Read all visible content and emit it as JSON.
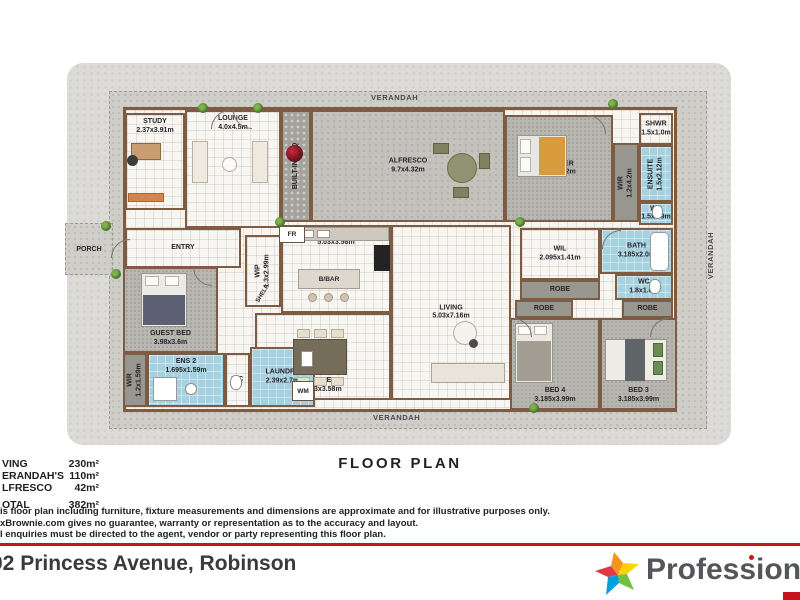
{
  "floor_plan_title": "FLOOR PLAN",
  "plan": {
    "verandah_top": "VERANDAH",
    "verandah_bottom": "VERANDAH",
    "verandah_right": "VERANDAH",
    "porch": "PORCH",
    "small_labels": {
      "fr": "FR",
      "wm": "WM",
      "shelf": "SHELF",
      "bbar": "B/BAR"
    },
    "rooms": [
      {
        "id": "study",
        "label": "STUDY",
        "dims": "2.37x3.91m",
        "type": "tile",
        "x": 60,
        "y": 58,
        "w": 60,
        "h": 97,
        "lp": "top"
      },
      {
        "id": "lounge",
        "label": "LOUNGE",
        "dims": "4.0x4.5m",
        "type": "tile",
        "x": 120,
        "y": 55,
        "w": 96,
        "h": 118,
        "lp": "top"
      },
      {
        "id": "built-in-bbq",
        "label": "BUILT-IN BBQ",
        "dims": "",
        "type": "stone",
        "x": 216,
        "y": 55,
        "w": 30,
        "h": 112,
        "vert": true
      },
      {
        "id": "alfresco",
        "label": "ALFRESCO",
        "dims": "9.7x4.32m",
        "type": "deck2",
        "x": 246,
        "y": 55,
        "w": 194,
        "h": 112,
        "lp": "center"
      },
      {
        "id": "master",
        "label": "MASTER",
        "dims": "3.88x4.2m",
        "type": "carpet",
        "x": 440,
        "y": 60,
        "w": 108,
        "h": 107,
        "lp": "center"
      },
      {
        "id": "wir-master",
        "label": "WIR",
        "dims": "1.2x4.2m",
        "type": "robe",
        "x": 548,
        "y": 88,
        "w": 26,
        "h": 79,
        "vert": true
      },
      {
        "id": "shwr",
        "label": "SHWR",
        "dims": "1.5x1.0m",
        "type": "tile",
        "x": 574,
        "y": 58,
        "w": 34,
        "h": 32,
        "lp": "center"
      },
      {
        "id": "ensuite",
        "label": "ENSUITE",
        "dims": "1.5x2.12m",
        "type": "wet",
        "x": 574,
        "y": 90,
        "w": 34,
        "h": 57,
        "vert": true
      },
      {
        "id": "wc-ensuite",
        "label": "WC",
        "dims": "1.5x0.9m",
        "type": "wet",
        "x": 574,
        "y": 147,
        "w": 34,
        "h": 23,
        "lp": "center"
      },
      {
        "id": "entry",
        "label": "ENTRY",
        "dims": "",
        "type": "tile",
        "x": 60,
        "y": 173,
        "w": 116,
        "h": 40,
        "lp": "center"
      },
      {
        "id": "wip",
        "label": "WIP",
        "dims": "1.3x2.99m",
        "type": "tile",
        "x": 180,
        "y": 180,
        "w": 36,
        "h": 72,
        "vert": true
      },
      {
        "id": "kitchen",
        "label": "KITCHEN",
        "dims": "5.03x3.58m",
        "type": "tile",
        "x": 216,
        "y": 170,
        "w": 110,
        "h": 88,
        "lp": "top"
      },
      {
        "id": "living",
        "label": "LIVING",
        "dims": "5.03x7.16m",
        "type": "tile",
        "x": 326,
        "y": 170,
        "w": 120,
        "h": 175,
        "lp": "center"
      },
      {
        "id": "dine",
        "label": "DINE",
        "dims": "5.03x3.58m",
        "type": "tile",
        "x": 190,
        "y": 258,
        "w": 136,
        "h": 87,
        "lp": "bottom"
      },
      {
        "id": "wil",
        "label": "WIL",
        "dims": "2.095x1.41m",
        "type": "tile",
        "x": 455,
        "y": 173,
        "w": 80,
        "h": 52,
        "lp": "center"
      },
      {
        "id": "robe-hall",
        "label": "ROBE",
        "dims": "",
        "type": "robe",
        "x": 455,
        "y": 225,
        "w": 80,
        "h": 20,
        "lp": "center"
      },
      {
        "id": "bath",
        "label": "BATH",
        "dims": "3.185x2.0m",
        "type": "wet",
        "x": 535,
        "y": 173,
        "w": 73,
        "h": 46,
        "lp": "center"
      },
      {
        "id": "wc-main",
        "label": "WC",
        "dims": "1.8x1.0m",
        "type": "wet",
        "x": 550,
        "y": 219,
        "w": 58,
        "h": 26,
        "lp": "center"
      },
      {
        "id": "robe-bed4",
        "label": "ROBE",
        "dims": "",
        "type": "robe",
        "x": 450,
        "y": 245,
        "w": 58,
        "h": 18,
        "lp": "center"
      },
      {
        "id": "robe-bed3",
        "label": "ROBE",
        "dims": "",
        "type": "robe",
        "x": 557,
        "y": 245,
        "w": 51,
        "h": 18,
        "lp": "center"
      },
      {
        "id": "bed4",
        "label": "BED 4",
        "dims": "3.185x3.99m",
        "type": "carpet",
        "x": 445,
        "y": 263,
        "w": 90,
        "h": 92,
        "lp": "bottom"
      },
      {
        "id": "bed3",
        "label": "BED 3",
        "dims": "3.185x3.99m",
        "type": "carpet",
        "x": 535,
        "y": 263,
        "w": 77,
        "h": 92,
        "lp": "bottom"
      },
      {
        "id": "guest-bed",
        "label": "GUEST BED",
        "dims": "3.98x3.6m",
        "type": "carpet",
        "x": 58,
        "y": 212,
        "w": 95,
        "h": 86,
        "lp": "bottom"
      },
      {
        "id": "wir-guest",
        "label": "WIR",
        "dims": "1.2x1.59m",
        "type": "robe",
        "x": 58,
        "y": 298,
        "w": 24,
        "h": 54,
        "vert": true
      },
      {
        "id": "ens2",
        "label": "ENS 2",
        "dims": "1.695x1.59m",
        "type": "wet",
        "x": 82,
        "y": 298,
        "w": 78,
        "h": 54,
        "lp": "top"
      },
      {
        "id": "wc-guest",
        "label": "WC",
        "dims": "",
        "type": "tile",
        "x": 160,
        "y": 298,
        "w": 25,
        "h": 54,
        "lp": "center"
      },
      {
        "id": "laundry",
        "label": "LAUNDRY",
        "dims": "2.39x2.7m",
        "type": "wet",
        "x": 185,
        "y": 292,
        "w": 65,
        "h": 60,
        "lp": "center"
      }
    ]
  },
  "areas": {
    "rows": [
      {
        "label": "VING",
        "value": "230m²"
      },
      {
        "label": "ERANDAH'S",
        "value": "110m²"
      },
      {
        "label": "LFRESCO",
        "value": "42m²"
      }
    ],
    "total": {
      "label": "OTAL",
      "value": "382m²"
    }
  },
  "disclaimer": [
    "is floor plan including furniture, fixture measurements and dimensions are approximate and for illustrative purposes only.",
    "xBrownie.com gives no guarantee, warranty or representation as to the accuracy and layout.",
    "l enquiries must be directed to the agent, vendor or party representing this floor plan."
  ],
  "footer": {
    "address": "02 Princess Avenue, Robinson",
    "brand": "Professionals",
    "accent_red": "#c4161c",
    "star_colors": {
      "red": "#e23a45",
      "orange": "#f7941e",
      "yellow": "#ffd200",
      "green": "#72bf44",
      "blue": "#00a0dd"
    }
  }
}
